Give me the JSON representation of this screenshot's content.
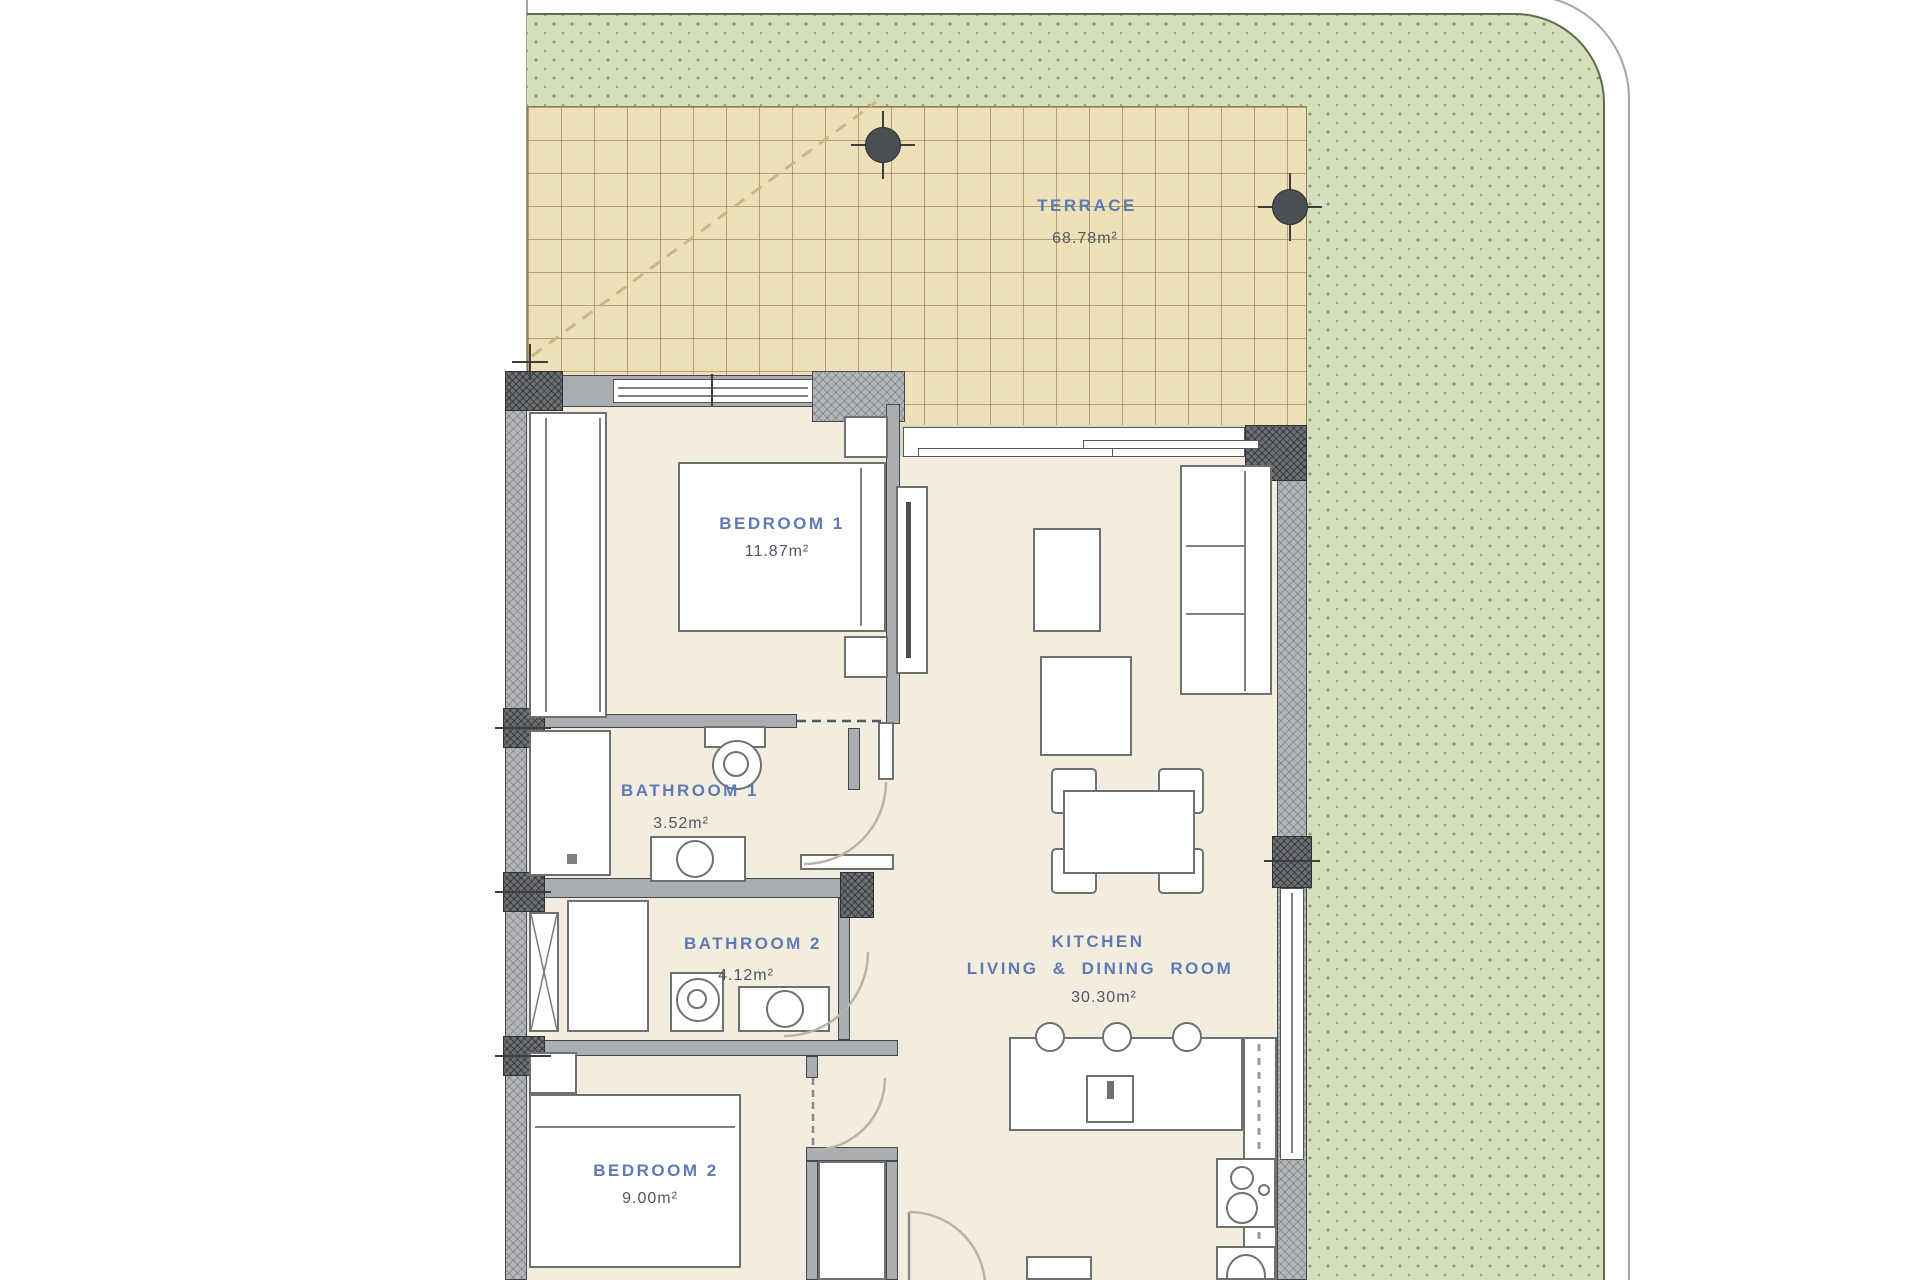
{
  "plan": {
    "rooms": {
      "terrace": {
        "name": "TERRACE",
        "area": "68.78m²"
      },
      "bedroom1": {
        "name": "BEDROOM 1",
        "area": "11.87m²"
      },
      "bathroom1": {
        "name": "BATHROOM 1",
        "area": "3.52m²"
      },
      "bathroom2": {
        "name": "BATHROOM 2",
        "area": "4.12m²"
      },
      "kitchen_living": {
        "name_line1": "KITCHEN",
        "name_line2": "LIVING & DINING ROOM",
        "area": "30.30m²"
      },
      "bedroom2": {
        "name": "BEDROOM 2",
        "area": "9.00m²"
      }
    },
    "colors": {
      "grass": "#d5dfbd",
      "grass_dots": "#89996d",
      "grass_border": "#5f6e50",
      "terrace_tile": "#eee1ba",
      "terrace_grid": "#a3905f",
      "wall": "#aaadb2",
      "wall_column": "#6b6e73",
      "floor": "#f2edde",
      "room_name_text": "#5e7ab4",
      "room_area_text": "#4e5665",
      "fixture_border": "#6f7072",
      "plot_line": "#a6a6a6"
    }
  }
}
